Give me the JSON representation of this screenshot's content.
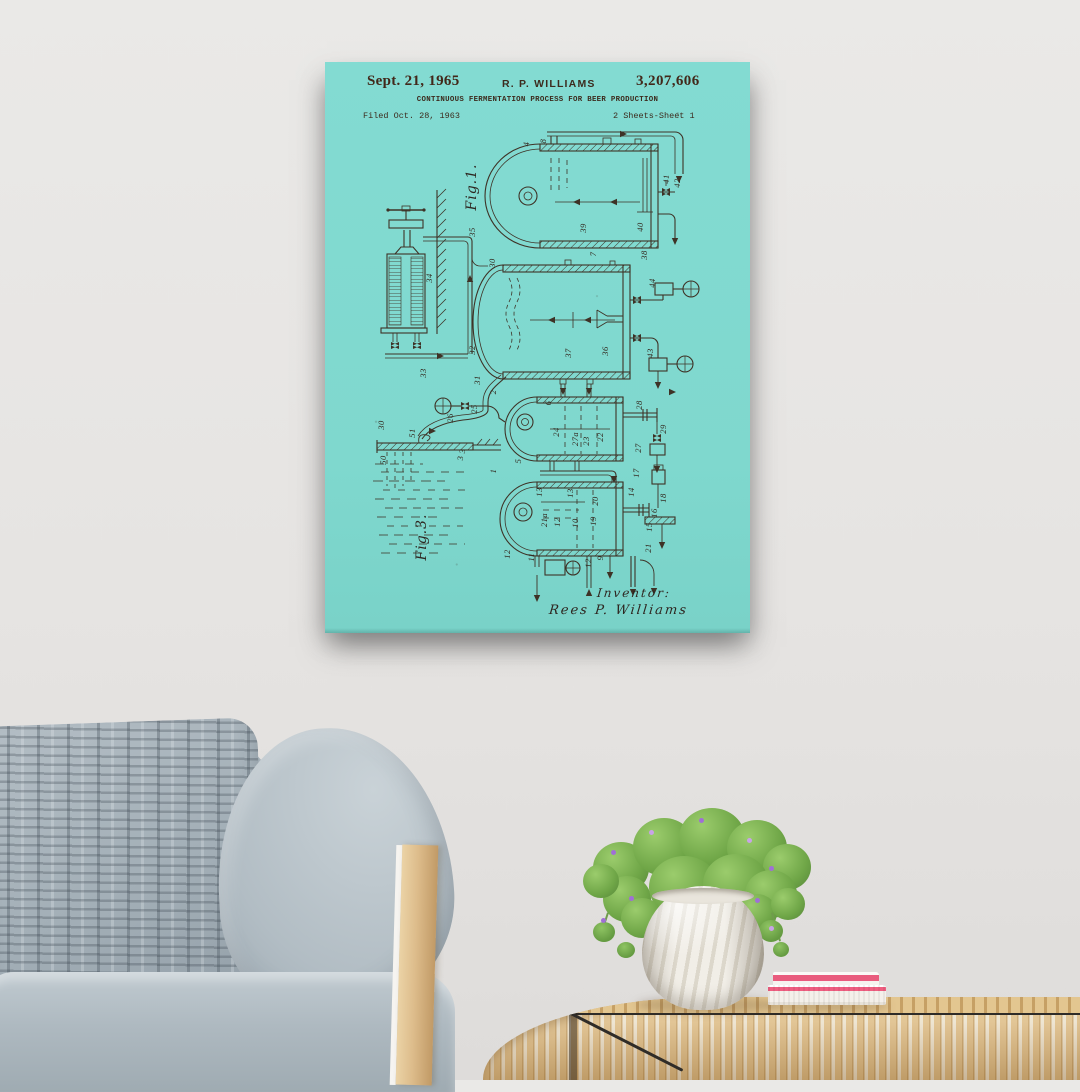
{
  "scene": {
    "wall_color": "#E6E4E2",
    "accent_colors": {
      "poster_paper": "#7FD8CE",
      "poster_ink": "#3E3226",
      "rattan": "#DCBA82",
      "book_pink": "#EF5E80"
    }
  },
  "poster": {
    "header": {
      "date": "Sept. 21, 1965",
      "author": "R. P. WILLIAMS",
      "patent_number": "3,207,606",
      "title": "CONTINUOUS FERMENTATION PROCESS FOR BEER PRODUCTION",
      "filed": "Filed Oct. 28, 1963",
      "sheet": "2 Sheets-Sheet 1"
    },
    "signature": {
      "label": "Inventor:",
      "name": "Rees P. Williams"
    },
    "figure_labels": [
      {
        "text": "Fig.1.",
        "x": 147,
        "y": 125
      },
      {
        "text": "Fig.3.",
        "x": 97,
        "y": 475
      }
    ],
    "part_labels": [
      {
        "text": "4",
        "x": 201,
        "y": 82
      },
      {
        "text": "8",
        "x": 218,
        "y": 79
      },
      {
        "text": "41",
        "x": 341,
        "y": 117
      },
      {
        "text": "42",
        "x": 352,
        "y": 121
      },
      {
        "text": "40",
        "x": 315,
        "y": 165
      },
      {
        "text": "39",
        "x": 258,
        "y": 166
      },
      {
        "text": "38",
        "x": 319,
        "y": 193
      },
      {
        "text": "7",
        "x": 268,
        "y": 192
      },
      {
        "text": "35",
        "x": 147,
        "y": 170
      },
      {
        "text": "34",
        "x": 104,
        "y": 216
      },
      {
        "text": "33",
        "x": 98,
        "y": 311
      },
      {
        "text": "30",
        "x": 167,
        "y": 201
      },
      {
        "text": "32",
        "x": 147,
        "y": 288
      },
      {
        "text": "31",
        "x": 152,
        "y": 318
      },
      {
        "text": "2",
        "x": 168,
        "y": 330
      },
      {
        "text": "37",
        "x": 243,
        "y": 291
      },
      {
        "text": "36",
        "x": 280,
        "y": 289
      },
      {
        "text": "44",
        "x": 327,
        "y": 221
      },
      {
        "text": "43",
        "x": 325,
        "y": 291
      },
      {
        "text": "6",
        "x": 223,
        "y": 341
      },
      {
        "text": "26",
        "x": 125,
        "y": 356
      },
      {
        "text": "25",
        "x": 149,
        "y": 347
      },
      {
        "text": "24",
        "x": 231,
        "y": 370
      },
      {
        "text": "27a",
        "x": 250,
        "y": 377
      },
      {
        "text": "23",
        "x": 261,
        "y": 379
      },
      {
        "text": "22",
        "x": 275,
        "y": 375
      },
      {
        "text": "28",
        "x": 314,
        "y": 343
      },
      {
        "text": "29",
        "x": 338,
        "y": 367
      },
      {
        "text": "27",
        "x": 313,
        "y": 386
      },
      {
        "text": "5",
        "x": 193,
        "y": 399
      },
      {
        "text": "3",
        "x": 137,
        "y": 389
      },
      {
        "text": "1",
        "x": 168,
        "y": 409
      },
      {
        "text": "13",
        "x": 214,
        "y": 430
      },
      {
        "text": "13",
        "x": 245,
        "y": 431
      },
      {
        "text": "20",
        "x": 270,
        "y": 439
      },
      {
        "text": "14",
        "x": 306,
        "y": 430
      },
      {
        "text": "17",
        "x": 311,
        "y": 411
      },
      {
        "text": "18",
        "x": 338,
        "y": 436
      },
      {
        "text": "16",
        "x": 329,
        "y": 451
      },
      {
        "text": "15",
        "x": 324,
        "y": 465
      },
      {
        "text": "19",
        "x": 268,
        "y": 459
      },
      {
        "text": "10",
        "x": 250,
        "y": 461
      },
      {
        "text": "21a",
        "x": 219,
        "y": 458
      },
      {
        "text": "12",
        "x": 232,
        "y": 460
      },
      {
        "text": "11",
        "x": 206,
        "y": 495
      },
      {
        "text": "12",
        "x": 182,
        "y": 492
      },
      {
        "text": "12",
        "x": 263,
        "y": 501
      },
      {
        "text": "9",
        "x": 275,
        "y": 496
      },
      {
        "text": "21",
        "x": 323,
        "y": 486
      },
      {
        "text": "50",
        "x": 58,
        "y": 398
      },
      {
        "text": "51",
        "x": 87,
        "y": 371
      },
      {
        "text": "30",
        "x": 56,
        "y": 363
      },
      {
        "text": "3",
        "x": 135,
        "y": 396
      }
    ]
  }
}
